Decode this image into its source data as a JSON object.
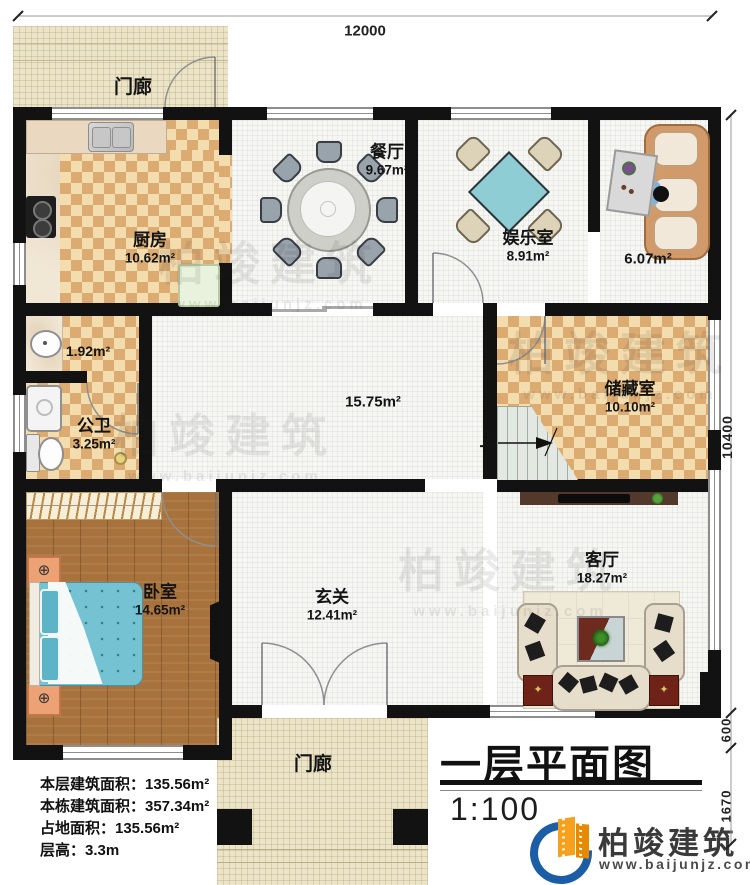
{
  "title": {
    "name": "一层平面图",
    "scale": "1:100"
  },
  "dimensions": {
    "top": "12000",
    "right_main": "10400",
    "right_600": "600",
    "right_1670": "1670"
  },
  "rooms": [
    {
      "id": "porch-top",
      "name": "门廊",
      "area": ""
    },
    {
      "id": "kitchen",
      "name": "厨房",
      "area": "10.62m²"
    },
    {
      "id": "dining",
      "name": "餐厅",
      "area": "9.67m²"
    },
    {
      "id": "entertainment",
      "name": "娱乐室",
      "area": "8.91m²"
    },
    {
      "id": "side-room",
      "name": "",
      "area": "6.07m²"
    },
    {
      "id": "laundry",
      "name": "",
      "area": "1.92m²"
    },
    {
      "id": "bathroom",
      "name": "公卫",
      "area": "3.25m²"
    },
    {
      "id": "hallway",
      "name": "",
      "area": "15.75m²"
    },
    {
      "id": "storage",
      "name": "储藏室",
      "area": "10.10m²"
    },
    {
      "id": "bedroom",
      "name": "卧室",
      "area": "14.65m²"
    },
    {
      "id": "foyer",
      "name": "玄关",
      "area": "12.41m²"
    },
    {
      "id": "living",
      "name": "客厅",
      "area": "18.27m²"
    },
    {
      "id": "porch-bottom",
      "name": "门廊",
      "area": ""
    }
  ],
  "stairs": {
    "up_label": "上"
  },
  "stats": [
    "本层建筑面积：135.56m²",
    "本栋建筑面积：357.34m²",
    "占地面积：135.56m²",
    "层高：3.3m"
  ],
  "brand": {
    "name": "柏竣建筑",
    "url": "www.baijunjz.com"
  },
  "watermark": {
    "text": "柏竣建筑",
    "url": "www.baijunjz.com"
  },
  "colors": {
    "wall": "#121212",
    "checker": "#dcab72",
    "cream": "#ece4c9",
    "wood": "#a8723d",
    "bed_blue": "#74c2d2",
    "card_table": "#8ecdd3",
    "logo_blue": "#1b5ea6",
    "logo_orange": "#f6a01b",
    "tv_cabinet": "#53392c",
    "side_table_red": "#6e2218"
  }
}
